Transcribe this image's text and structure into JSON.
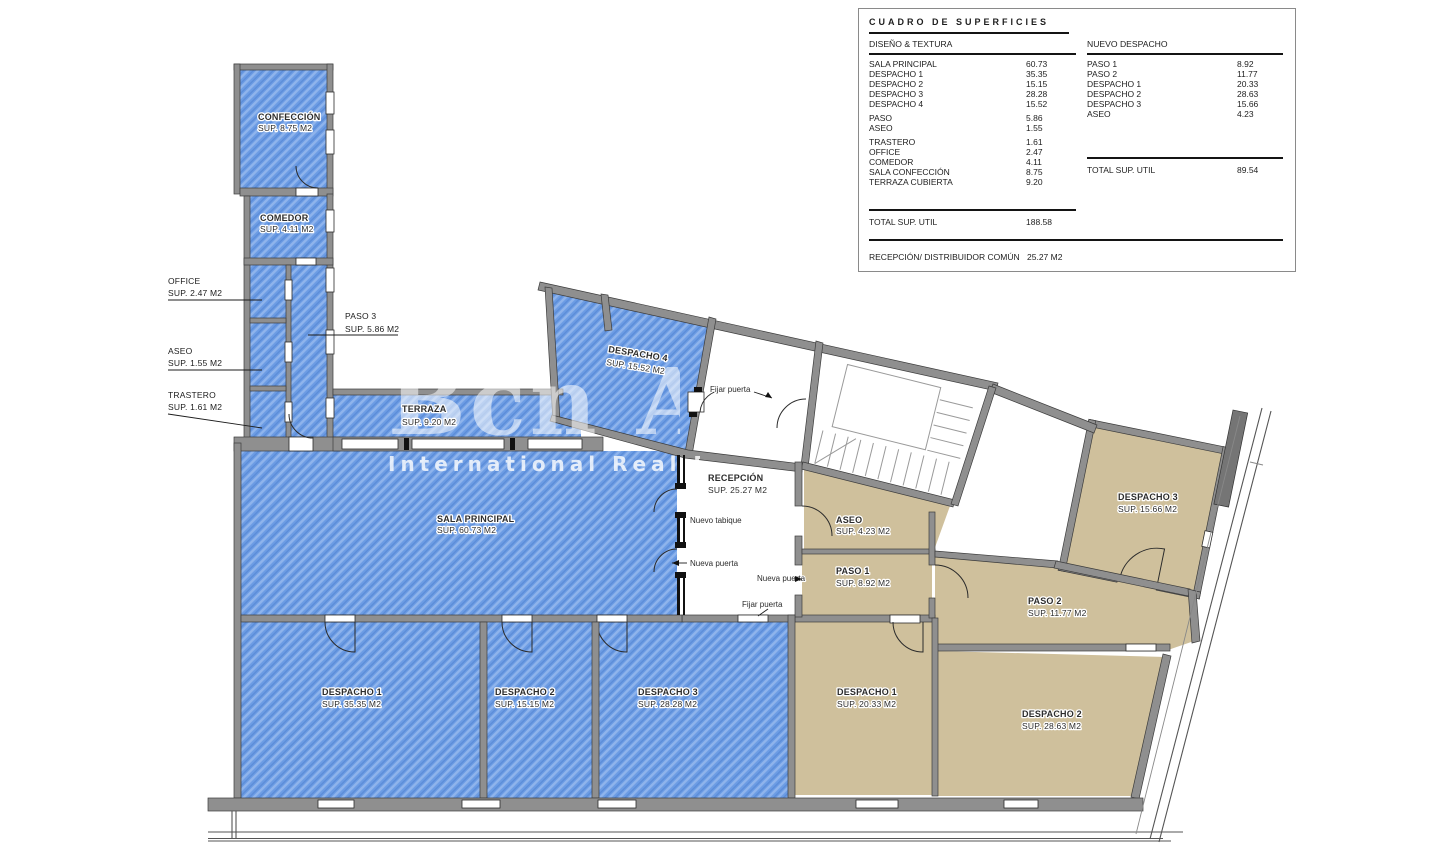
{
  "surface_table": {
    "title": "CUADRO DE SUPERFICIES",
    "left": {
      "header": "DISEÑO & TEXTURA",
      "rows": [
        {
          "label": "SALA PRINCIPAL",
          "value": "60.73"
        },
        {
          "label": "DESPACHO 1",
          "value": "35.35"
        },
        {
          "label": "DESPACHO 2",
          "value": "15.15"
        },
        {
          "label": "DESPACHO 3",
          "value": "28.28"
        },
        {
          "label": "DESPACHO 4",
          "value": "15.52"
        },
        {
          "label": "PASO",
          "value": "5.86"
        },
        {
          "label": "ASEO",
          "value": "1.55"
        },
        {
          "label": "TRASTERO",
          "value": "1.61"
        },
        {
          "label": "OFFICE",
          "value": "2.47"
        },
        {
          "label": "COMEDOR",
          "value": "4.11"
        },
        {
          "label": "SALA CONFECCIÓN",
          "value": "8.75"
        },
        {
          "label": "TERRAZA CUBIERTA",
          "value": "9.20"
        }
      ],
      "total_label": "TOTAL SUP. UTIL",
      "total_value": "188.58"
    },
    "right": {
      "header": "NUEVO DESPACHO",
      "rows": [
        {
          "label": "PASO 1",
          "value": "8.92"
        },
        {
          "label": "PASO 2",
          "value": "11.77"
        },
        {
          "label": "DESPACHO 1",
          "value": "20.33"
        },
        {
          "label": "DESPACHO 2",
          "value": "28.63"
        },
        {
          "label": "DESPACHO 3",
          "value": "15.66"
        },
        {
          "label": "ASEO",
          "value": "4.23"
        }
      ],
      "total_label": "TOTAL SUP. UTIL",
      "total_value": "89.54"
    },
    "footer": {
      "label": "RECEPCIÓN/ DISTRIBUIDOR COMÚN",
      "value": "25.27 M2"
    }
  },
  "watermark": {
    "line1": "Bcn Advisors",
    "line2": "International Real Estate"
  },
  "plan": {
    "colors": {
      "blue": "#6c9ce4",
      "blue_light": "#8fb4ec",
      "tan": "#cfc09c",
      "wall": "#8f8f8f"
    },
    "rooms": {
      "confeccion": {
        "name": "CONFECCIÓN",
        "sup": "SUP. 8.75 M2"
      },
      "comedor": {
        "name": "COMEDOR",
        "sup": "SUP. 4.11 M2"
      },
      "office": {
        "name": "OFFICE",
        "sup": "SUP. 2.47 M2"
      },
      "aseo_left": {
        "name": "ASEO",
        "sup": "SUP. 1.55 M2"
      },
      "trastero": {
        "name": "TRASTERO",
        "sup": "SUP. 1.61 M2"
      },
      "paso3": {
        "name": "PASO 3",
        "sup": "SUP. 5.86 M2"
      },
      "terraza": {
        "name": "TERRAZA",
        "sup": "SUP. 9.20 M2"
      },
      "despacho4": {
        "name": "DESPACHO 4",
        "sup": "SUP. 15.52 M2"
      },
      "sala_principal": {
        "name": "SALA PRINCIPAL",
        "sup": "SUP. 60.73 M2"
      },
      "recepcion": {
        "name": "RECEPCIÓN",
        "sup": "SUP. 25.27 M2"
      },
      "aseo_right": {
        "name": "ASEO",
        "sup": "SUP. 4.23 M2"
      },
      "paso1": {
        "name": "PASO 1",
        "sup": "SUP. 8.92 M2"
      },
      "paso2": {
        "name": "PASO 2",
        "sup": "SUP. 11.77 M2"
      },
      "despacho3_right": {
        "name": "DESPACHO 3",
        "sup": "SUP. 15.66 M2"
      },
      "despacho1_blue": {
        "name": "DESPACHO 1",
        "sup": "SUP. 35.35 M2"
      },
      "despacho2_blue": {
        "name": "DESPACHO 2",
        "sup": "SUP. 15.15 M2"
      },
      "despacho3_blue": {
        "name": "DESPACHO 3",
        "sup": "SUP. 28.28 M2"
      },
      "despacho1_tan": {
        "name": "DESPACHO 1",
        "sup": "SUP. 20.33 M2"
      },
      "despacho2_tan": {
        "name": "DESPACHO 2",
        "sup": "SUP. 28.63 M2"
      }
    },
    "annotations": {
      "fijar_puerta": "Fijar puerta",
      "nueva_puerta": "Nueva puerta",
      "nuevo_tabique": "Nuevo tabique"
    }
  }
}
